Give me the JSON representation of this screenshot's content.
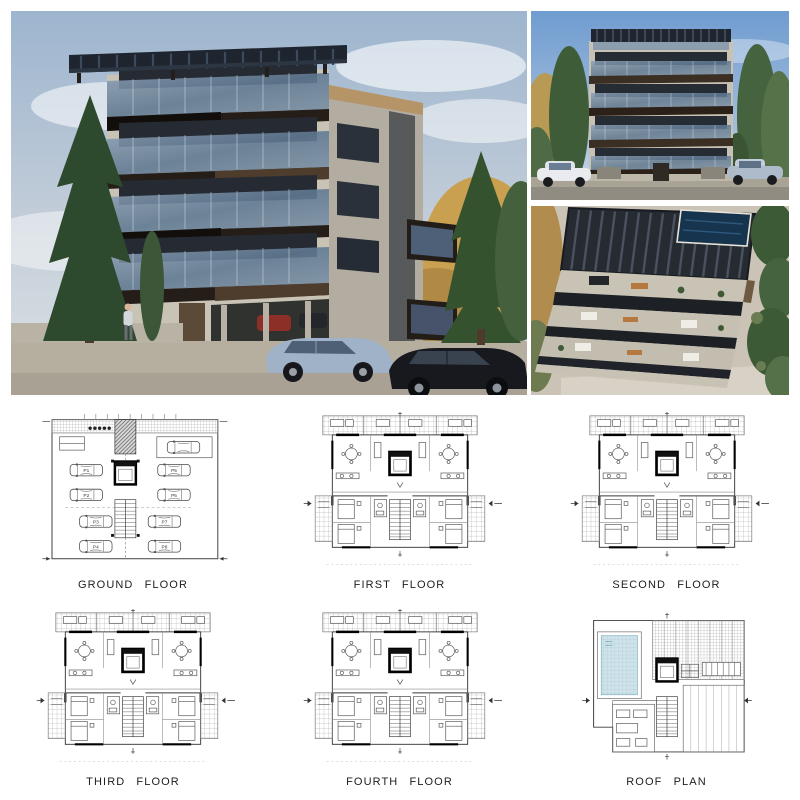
{
  "board": {
    "type": "architectural presentation board",
    "sections": {
      "renders": 3,
      "floor_plans": 6
    }
  },
  "renders": [
    {
      "name": "street perspective render"
    },
    {
      "name": "front elevation render"
    },
    {
      "name": "aerial balconies render"
    }
  ],
  "plans": [
    {
      "id": "ground-floor",
      "label": "GROUND FLOOR"
    },
    {
      "id": "first-floor",
      "label": "FIRST FLOOR"
    },
    {
      "id": "second-floor",
      "label": "SECOND FLOOR"
    },
    {
      "id": "third-floor",
      "label": "THIRD FLOOR"
    },
    {
      "id": "fourth-floor",
      "label": "FOURTH FLOOR"
    },
    {
      "id": "roof-plan",
      "label": "ROOF PLAN"
    }
  ],
  "ground_floor": {
    "parking_labels": [
      "P1",
      "P2",
      "P3",
      "P4",
      "P5",
      "P6",
      "P7",
      "P8"
    ]
  },
  "palette": {
    "sky_grey_blue": "#bdc9d5",
    "sky_blue": "#86abd3",
    "concrete": "#c8c2b5",
    "bronze_fascia": "#3b2f24",
    "balcony_glass": "#7e96ad",
    "pergola_dark": "#202733",
    "pool_render": "#17344e",
    "pool_plan": "#cfe3ea",
    "plan_line": "#444444",
    "autumn_tree": "#c09a52",
    "conifer_green": "#2e4a2e"
  }
}
